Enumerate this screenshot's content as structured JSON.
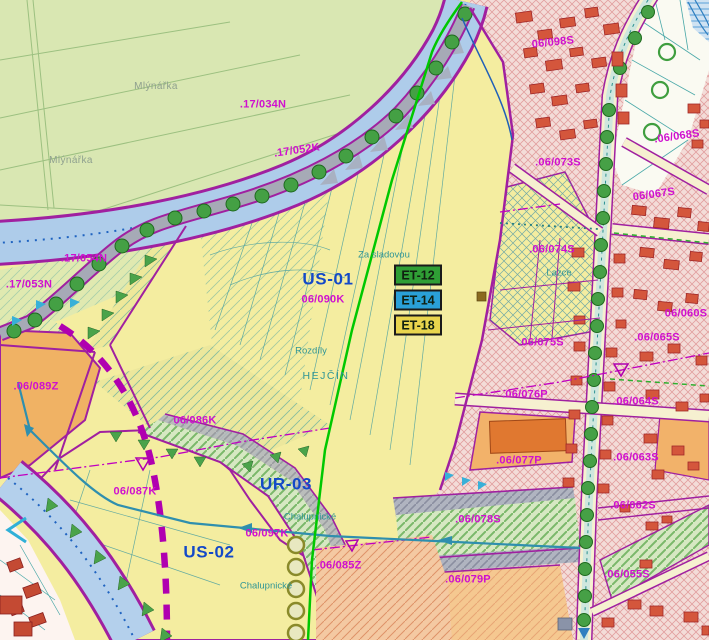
{
  "map": {
    "labels": [
      {
        "text": "Mlýnářka",
        "x": 156,
        "y": 87,
        "kind": "gray"
      },
      {
        "text": "Mlýnářka",
        "x": 71,
        "y": 161,
        "kind": "gray"
      },
      {
        "text": ".17/034N",
        "x": 263,
        "y": 105,
        "kind": "parcel"
      },
      {
        "text": ".17/052K",
        "x": 297,
        "y": 151,
        "kind": "parcel",
        "rot": -8
      },
      {
        "text": ".17/054N",
        "x": 84,
        "y": 259,
        "kind": "parcel"
      },
      {
        "text": ".17/053N",
        "x": 29,
        "y": 285,
        "kind": "parcel"
      },
      {
        "text": "US-01",
        "x": 328,
        "y": 279,
        "kind": "zone"
      },
      {
        "text": "06/090K",
        "x": 323,
        "y": 300,
        "kind": "parcel"
      },
      {
        "text": "Za sladovou",
        "x": 384,
        "y": 255,
        "kind": "place"
      },
      {
        "text": "Rozdíly",
        "x": 311,
        "y": 351,
        "kind": "place"
      },
      {
        "text": "HEJČÍN",
        "x": 326,
        "y": 376,
        "kind": "place-caps"
      },
      {
        "text": "06/086K",
        "x": 195,
        "y": 421,
        "kind": "parcel"
      },
      {
        "text": ".06/089Z",
        "x": 36,
        "y": 387,
        "kind": "parcel"
      },
      {
        "text": "06/087K",
        "x": 135,
        "y": 492,
        "kind": "parcel"
      },
      {
        "text": "UR-03",
        "x": 286,
        "y": 484,
        "kind": "zone"
      },
      {
        "text": "06/097K",
        "x": 267,
        "y": 534,
        "kind": "parcel"
      },
      {
        "text": "US-02",
        "x": 209,
        "y": 552,
        "kind": "zone"
      },
      {
        "text": "Chalupnické",
        "x": 310,
        "y": 517,
        "kind": "place"
      },
      {
        "text": "Chalupnické",
        "x": 266,
        "y": 586,
        "kind": "place"
      },
      {
        "text": ".06/085Z",
        "x": 339,
        "y": 566,
        "kind": "parcel"
      },
      {
        "text": "06/098S",
        "x": 553,
        "y": 43,
        "kind": "parcel",
        "rot": -6
      },
      {
        "text": ".06/068S",
        "x": 677,
        "y": 137,
        "kind": "parcel",
        "rot": -8
      },
      {
        "text": ".06/073S",
        "x": 558,
        "y": 163,
        "kind": "parcel"
      },
      {
        "text": "06/067S",
        "x": 654,
        "y": 195,
        "kind": "parcel",
        "rot": -8
      },
      {
        "text": ".06/074S",
        "x": 552,
        "y": 250,
        "kind": "parcel"
      },
      {
        "text": "Lazce",
        "x": 559,
        "y": 273,
        "kind": "place"
      },
      {
        "text": "06/060S",
        "x": 686,
        "y": 314,
        "kind": "parcel"
      },
      {
        "text": ".06/065S",
        "x": 657,
        "y": 338,
        "kind": "parcel"
      },
      {
        "text": ".06/075S",
        "x": 541,
        "y": 343,
        "kind": "parcel"
      },
      {
        "text": ".06/076P",
        "x": 525,
        "y": 395,
        "kind": "parcel"
      },
      {
        "text": ".06/064S",
        "x": 636,
        "y": 402,
        "kind": "parcel"
      },
      {
        "text": ".06/077P",
        "x": 519,
        "y": 461,
        "kind": "parcel"
      },
      {
        "text": ".06/063S",
        "x": 636,
        "y": 458,
        "kind": "parcel"
      },
      {
        "text": ".06/062S",
        "x": 633,
        "y": 506,
        "kind": "parcel"
      },
      {
        "text": ".06/078S",
        "x": 478,
        "y": 520,
        "kind": "parcel"
      },
      {
        "text": ".06/055S",
        "x": 627,
        "y": 575,
        "kind": "parcel"
      },
      {
        "text": ".06/079P",
        "x": 468,
        "y": 580,
        "kind": "parcel"
      }
    ],
    "et_markers": [
      {
        "label": "ET-12",
        "x": 418,
        "y": 275,
        "color": "#2f9e35"
      },
      {
        "label": "ET-14",
        "x": 418,
        "y": 300,
        "color": "#2aa0d8"
      },
      {
        "label": "ET-18",
        "x": 418,
        "y": 325,
        "color": "#e9d54d"
      }
    ],
    "colors": {
      "pale_green_fields": "#d9e7b2",
      "pale_yellow_zone": "#f4eda0",
      "water_blue": "#aeccea",
      "boundary_magenta": "#a020a0",
      "urban_pink": "#f3dcd8",
      "building_red": "#d4563c",
      "orange_zone": "#f0b264",
      "salmon_zone": "#f4c9a2",
      "street_cream": "#f6f0d0",
      "label_magenta": "#cf10cf",
      "label_blue": "#1349c8",
      "label_teal": "#2f9595",
      "green_utility_line": "#00c800",
      "tree_green": "#44a044"
    }
  }
}
